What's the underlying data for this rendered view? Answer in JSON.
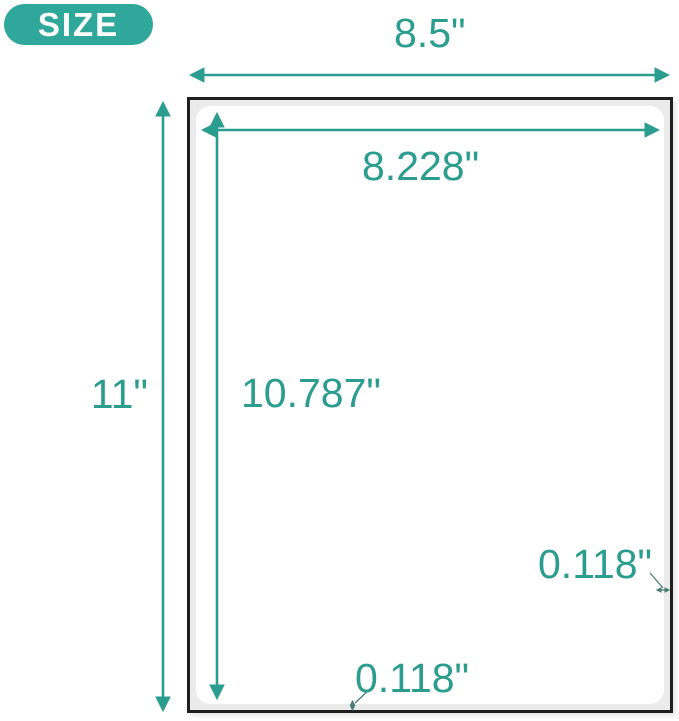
{
  "badge": {
    "label": "SIZE"
  },
  "diagram": {
    "sheet": {
      "width": "8.5\"",
      "height": "11\""
    },
    "label_area": {
      "width": "8.228\"",
      "height": "10.787\""
    },
    "margins": {
      "right": "0.118\"",
      "bottom": "0.118\""
    }
  },
  "colors": {
    "accent": "#2A9D8F",
    "badge": "#2FA79B",
    "leader": "#4A7D76",
    "paper_border": "#1F1F1F",
    "paper_margin": "#EBEBEB",
    "label_fill": "#FFFFFF"
  }
}
